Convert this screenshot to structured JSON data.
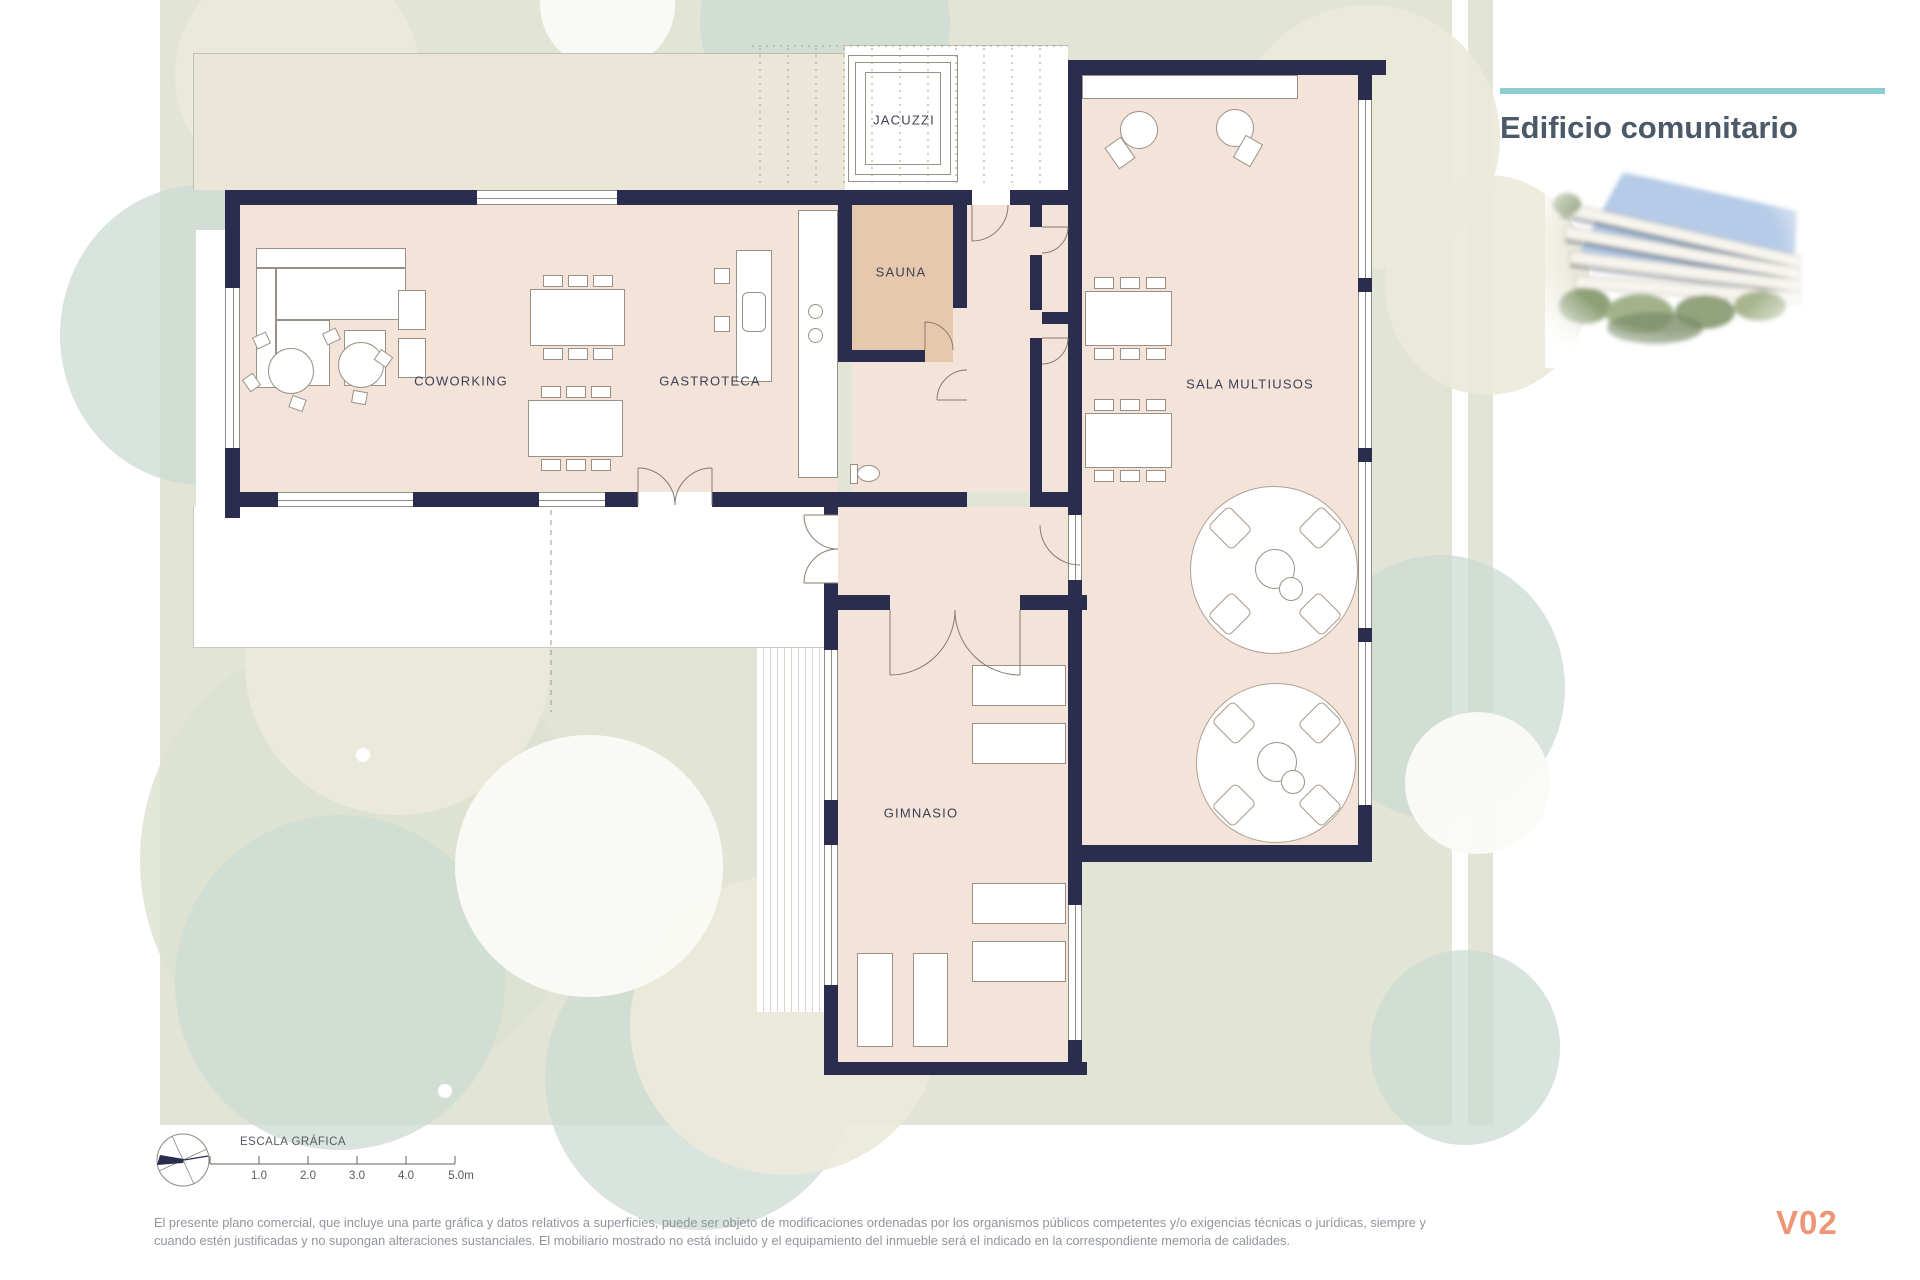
{
  "header": {
    "title": "Edificio comunitario"
  },
  "rooms": {
    "jacuzzi": "JACUZZI",
    "sauna": "SAUNA",
    "coworking": "COWORKING",
    "gastroteca": "GASTROTECA",
    "sala_multiusos": "SALA MULTIUSOS",
    "gimnasio": "GIMNASIO"
  },
  "scale_bar": {
    "title": "ESCALA GRÁFICA",
    "ticks": [
      "1.0",
      "2.0",
      "3.0",
      "4.0",
      "5.0m"
    ]
  },
  "footer": {
    "disclaimer_line1": "El presente plano comercial, que incluye una parte gráfica y datos relativos a superficies, puede ser objeto de modificaciones ordenadas por los organismos públicos competentes y/o exigencias técnicas o jurídicas, siempre y",
    "disclaimer_line2": "cuando estén justificadas y no supongan alteraciones sustanciales. El mobiliario mostrado no está incluido y el equipamiento del inmueble será el indicado en la correspondiente memoria de calidades.",
    "version_code": "V02"
  },
  "colors": {
    "accent_teal": "#8ccdd3",
    "wall_navy": "#2a2d4e",
    "floor_pink": "#f3e3d9",
    "sauna_tan": "#e6c9ac",
    "site_green": "#e2e4d6",
    "version_coral": "#ee9576"
  }
}
